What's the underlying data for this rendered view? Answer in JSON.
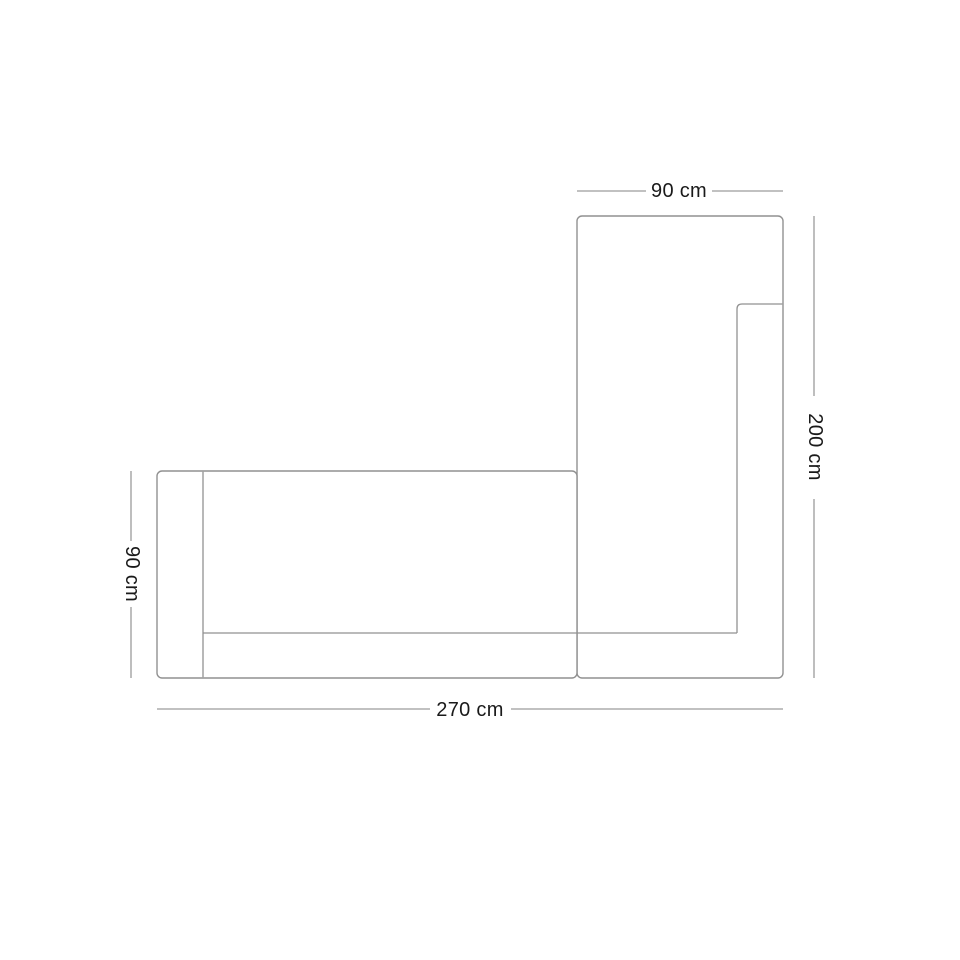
{
  "colors": {
    "background": "#ffffff",
    "outline": "#919191",
    "dimension_line": "#9c9c9c",
    "label_text": "#1a1a1a"
  },
  "diagram": {
    "type": "furniture-dimension-plan",
    "subject": "l-shaped-sectional-sofa-top-view",
    "labels": {
      "top_width": "90 cm",
      "right_height": "200 cm",
      "left_depth": "90 cm",
      "bottom_width": "270 cm"
    }
  }
}
